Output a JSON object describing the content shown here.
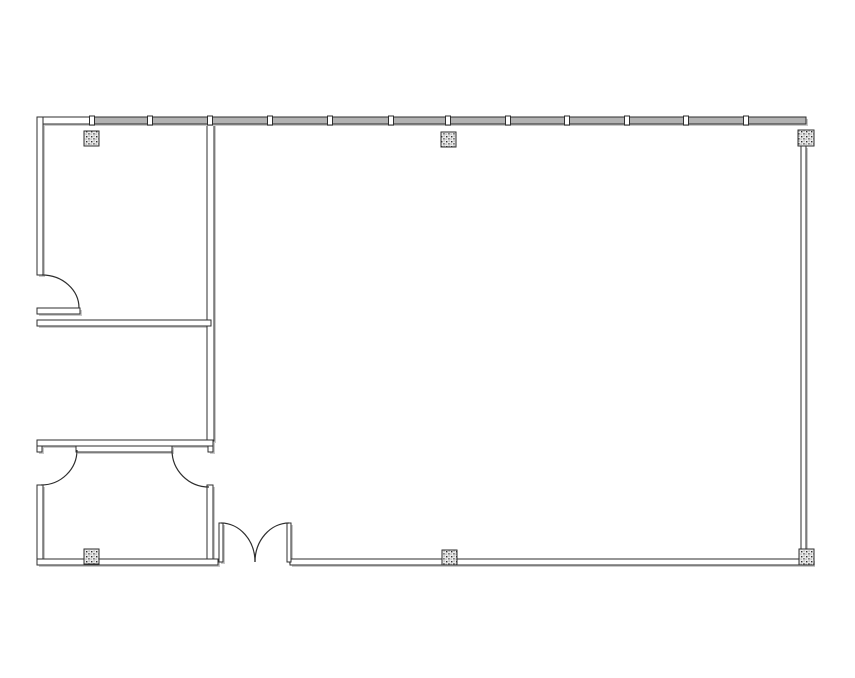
{
  "drawing": {
    "kind": "architectural-floor-plan",
    "canvas": {
      "w": 855,
      "h": 678,
      "background": "#ffffff"
    },
    "style": {
      "line": "#2e2e2e",
      "wallFill": "#ffffff",
      "glassFill": "#b2b2b2",
      "shadow": "#c9c9c9",
      "tickFill": "#ffffff",
      "columnBase": "#ececec",
      "columnDot": "#2e2e2e"
    },
    "walls": [
      {
        "name": "top-wall-west-segment",
        "x": 37,
        "y": 117,
        "w": 55,
        "h": 7
      },
      {
        "name": "exterior-wall-west-upper",
        "x": 37,
        "y": 117,
        "w": 6,
        "h": 158
      },
      {
        "name": "partition-wall-vertical",
        "x": 207,
        "y": 124,
        "w": 7,
        "h": 317
      },
      {
        "name": "partition-stub-room1",
        "x": 37,
        "y": 308,
        "w": 43,
        "h": 6
      },
      {
        "name": "partition-wall-mid",
        "x": 37,
        "y": 320,
        "w": 174,
        "h": 6
      },
      {
        "name": "partition-wall-lower",
        "x": 37,
        "y": 440,
        "w": 176,
        "h": 6
      },
      {
        "name": "lower-wall-cap-west",
        "x": 37,
        "y": 446,
        "w": 5,
        "h": 6
      },
      {
        "name": "lower-wall-stub-center",
        "x": 76,
        "y": 446,
        "w": 96,
        "h": 6
      },
      {
        "name": "lower-wall-cap-east",
        "x": 208,
        "y": 446,
        "w": 5,
        "h": 6
      },
      {
        "name": "exterior-wall-west-lower",
        "x": 37,
        "y": 485,
        "w": 6,
        "h": 80
      },
      {
        "name": "room3-wall-east",
        "x": 207,
        "y": 485,
        "w": 6,
        "h": 75
      },
      {
        "name": "bottom-wall-west",
        "x": 37,
        "y": 559,
        "w": 181,
        "h": 6
      },
      {
        "name": "bottom-wall-east",
        "x": 290,
        "y": 559,
        "w": 523,
        "h": 6
      },
      {
        "name": "exterior-wall-east",
        "x": 801,
        "y": 146,
        "w": 5,
        "h": 404
      },
      {
        "name": "entry-door-left-leaf",
        "x": 219,
        "y": 523,
        "w": 4,
        "h": 39
      },
      {
        "name": "entry-door-right-leaf",
        "x": 287,
        "y": 523,
        "w": 4,
        "h": 39
      }
    ],
    "curtain_wall": {
      "name": "curtain-wall-north",
      "x": 92,
      "y": 117,
      "w": 714,
      "h": 7,
      "mullions": [
        92,
        150,
        210,
        270,
        330,
        391,
        448,
        508,
        567,
        627,
        686,
        746
      ],
      "tick_w": 5,
      "tick_h": 9
    },
    "door_swings": [
      {
        "name": "room1-door-swing",
        "d": "M 42 275 A 37 33 0 0 1 79 308"
      },
      {
        "name": "room3-door-west-swing",
        "d": "M 77 450 A 36 35 0 0 1 41 485"
      },
      {
        "name": "room3-door-east-swing",
        "d": "M 172 450 A 37 37 0 0 0 209 487"
      },
      {
        "name": "entry-door-left-swing",
        "d": "M 221 523 A 34 39 0 0 1 255 562"
      },
      {
        "name": "entry-door-right-swing",
        "d": "M 289 523 A 34 39 0 0 0 255 562"
      }
    ],
    "columns": [
      {
        "name": "column-northwest",
        "x": 84,
        "y": 131,
        "w": 15,
        "h": 15
      },
      {
        "name": "column-north-mid",
        "x": 441,
        "y": 132,
        "w": 15,
        "h": 15
      },
      {
        "name": "column-northeast",
        "x": 798,
        "y": 130,
        "w": 16,
        "h": 16
      },
      {
        "name": "column-southwest",
        "x": 84,
        "y": 549,
        "w": 15,
        "h": 15
      },
      {
        "name": "column-south-mid",
        "x": 442,
        "y": 550,
        "w": 15,
        "h": 15
      },
      {
        "name": "column-southeast",
        "x": 799,
        "y": 549,
        "w": 15,
        "h": 16
      }
    ]
  }
}
